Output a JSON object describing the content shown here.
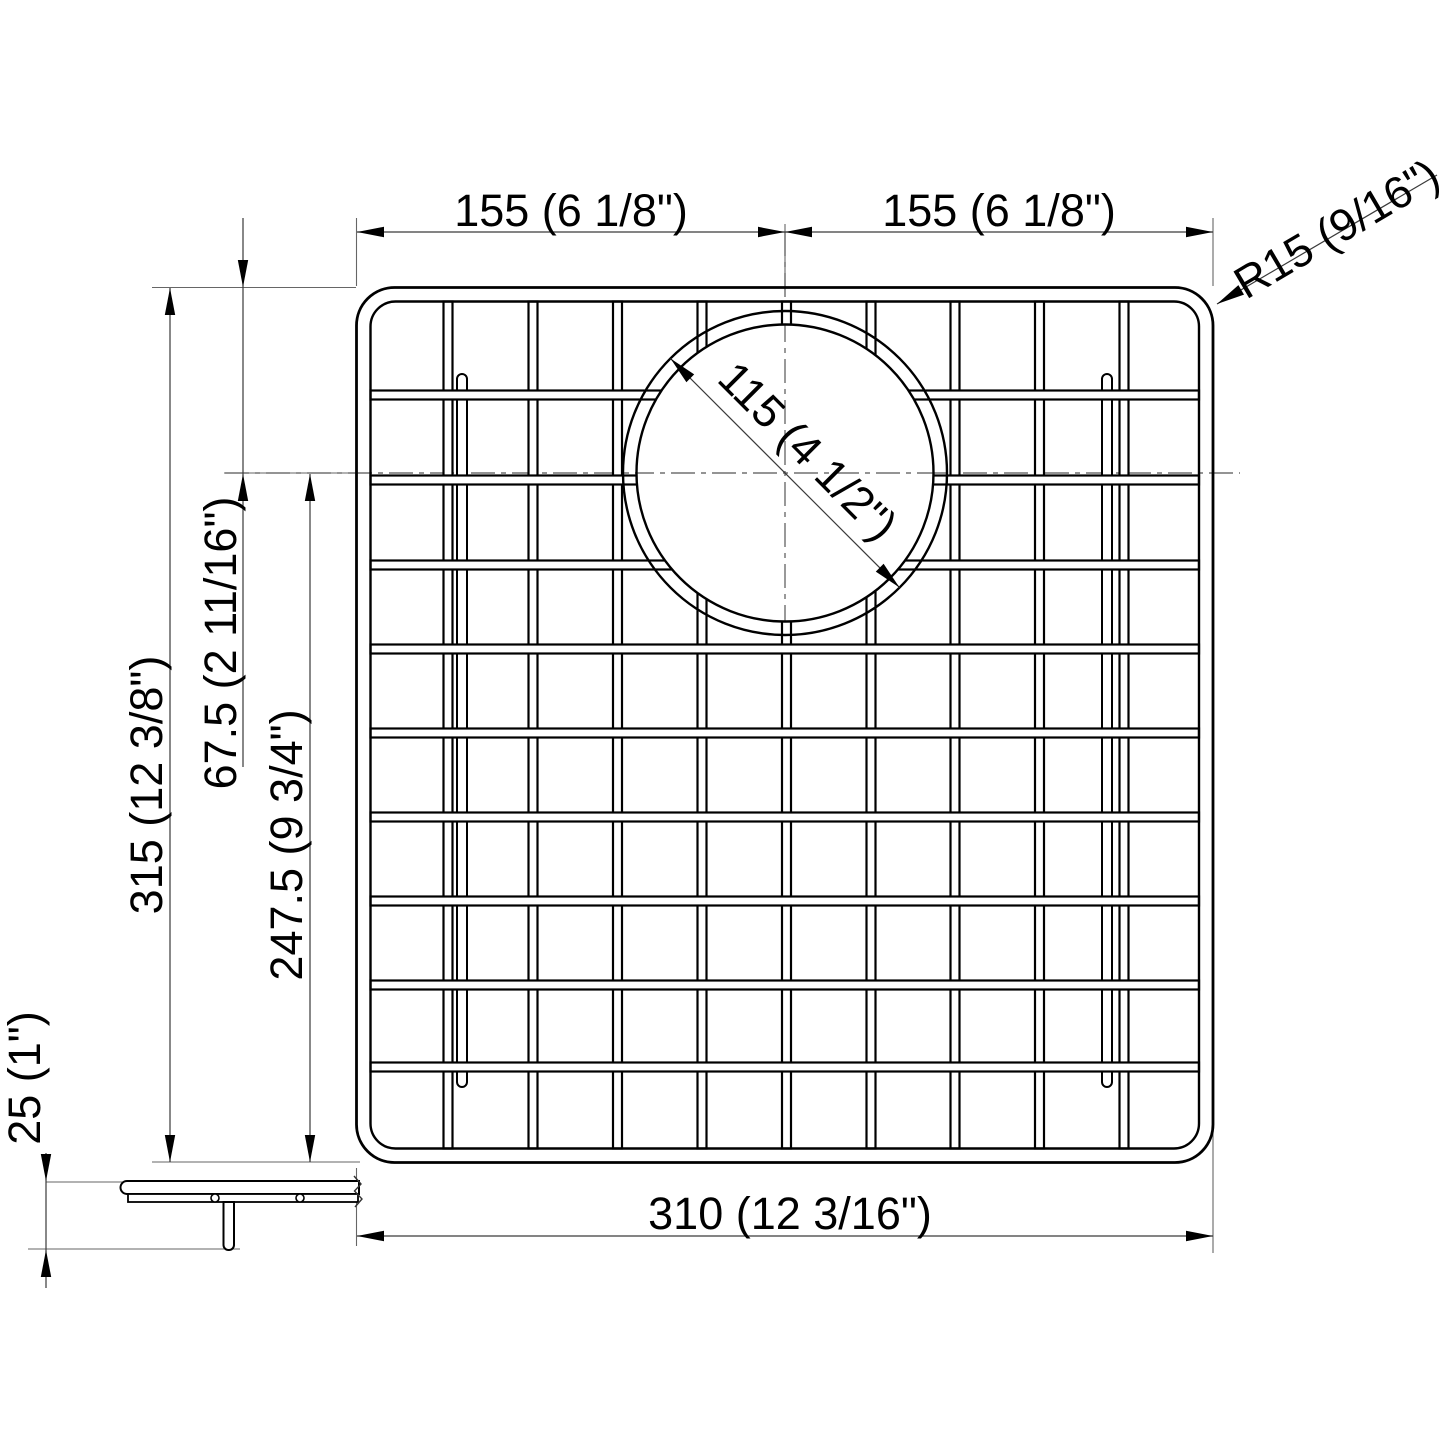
{
  "diagram": {
    "type": "technical-drawing",
    "subject": "sink bottom grid with rear drain opening, plan and side views",
    "colors": {
      "line": "#000000",
      "thin_line": "#666666",
      "background": "#ffffff"
    },
    "dimensions": {
      "top_left_half_width": "155 (6 1/8\")",
      "top_right_half_width": "155 (6 1/8\")",
      "corner_radius": "R15 (9/16\")",
      "drain_diameter": "115 (4 1/2\")",
      "overall_depth": "315 (12 3/8\")",
      "drain_center_from_top": "67.5 (2 11/16\")",
      "drain_center_from_bottom": "247.5 (9 3/4\")",
      "overall_width": "310 (12 3/16\")",
      "grid_height": "25 (1\")"
    }
  }
}
